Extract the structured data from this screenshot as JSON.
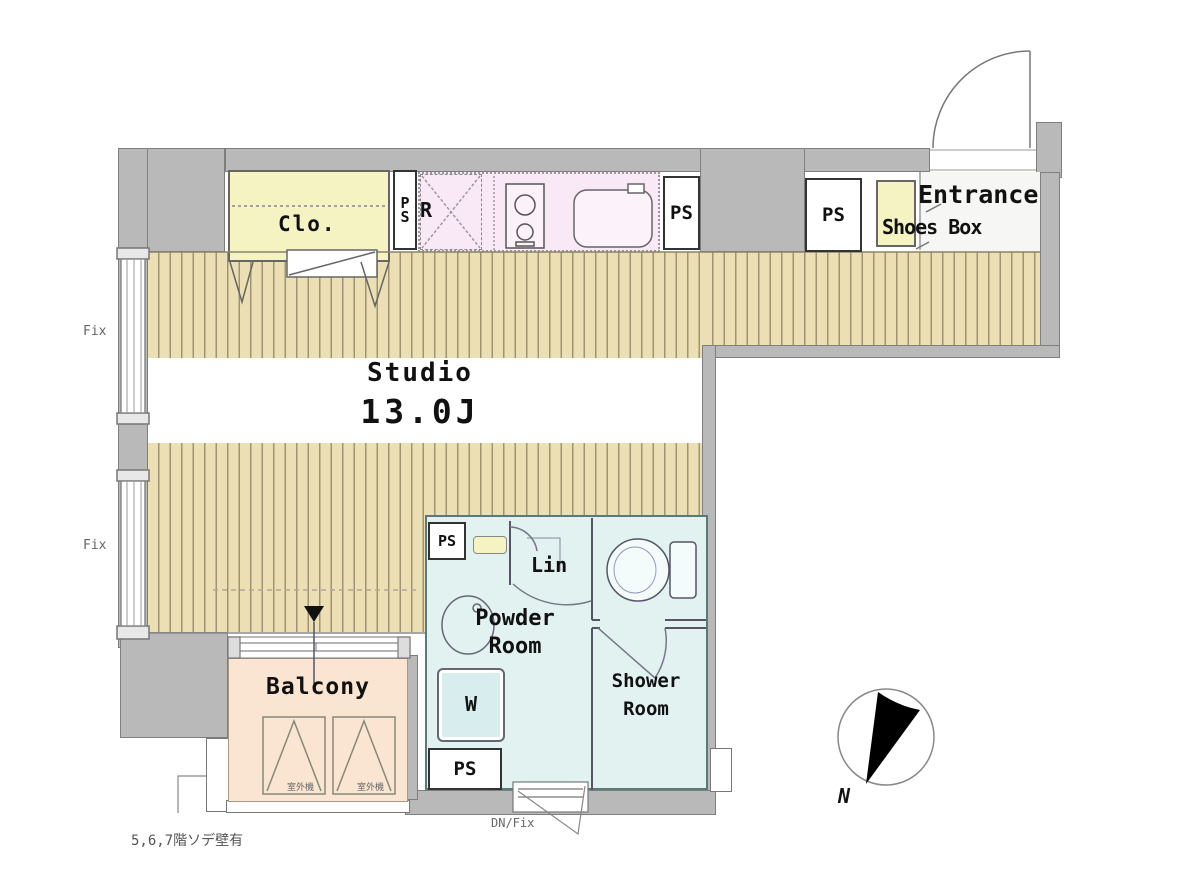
{
  "rooms": {
    "studio": {
      "label": "Studio",
      "size": "13.0J"
    },
    "powder": {
      "line1": "Powder",
      "line2": "Room"
    },
    "shower": {
      "line1": "Shower",
      "line2": "Room"
    },
    "balcony": {
      "label": "Balcony"
    },
    "entrance": {
      "label": "Entrance"
    },
    "shoes_box": {
      "label": "Shoes Box"
    },
    "closet": {
      "label": "Clo."
    },
    "linen": {
      "label": "Lin"
    },
    "fridge": {
      "label": "R"
    },
    "washer": {
      "label": "W"
    }
  },
  "labels": {
    "ps": "PS",
    "ps_p": "P",
    "ps_s": "S",
    "fix": "Fix",
    "dn_fix": "DN/Fix",
    "compass_n": "N",
    "note_bottom_left": "5,6,7階ソデ壁有",
    "balcony_panel_text": "室外機"
  },
  "colors": {
    "wall": "#b9b9b9",
    "floor": "#ecdfb4",
    "floor_stripe": "#9e9474",
    "closet_yellow": "#f6f3c3",
    "kitchen_pink": "#f9e9f6",
    "sanitary_blue": "#e1f2f1",
    "balcony_peach": "#fae5d3"
  }
}
